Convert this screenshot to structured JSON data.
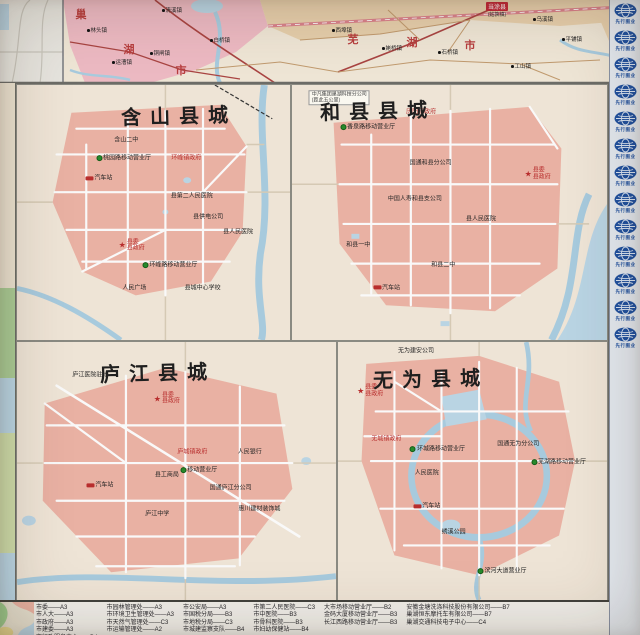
{
  "colors": {
    "urban_pink": "#f0b2a2",
    "region_pink": "#f2bac4",
    "land_cream": "#f2e7d7",
    "water_blue": "#a6cde2",
    "road_red": "#b0413e",
    "label_red": "#c22828",
    "mobile_green": "#1f8c24",
    "badge_blue": "#1950a8"
  },
  "top_map": {
    "region_chars": [
      {
        "ch": "巢",
        "x": 81,
        "y": 14
      },
      {
        "ch": "湖",
        "x": 129,
        "y": 49
      },
      {
        "ch": "市",
        "x": 181,
        "y": 70
      },
      {
        "ch": "芜",
        "x": 353,
        "y": 39
      },
      {
        "ch": "湖",
        "x": 412,
        "y": 42
      },
      {
        "ch": "市",
        "x": 470,
        "y": 45
      }
    ],
    "towns": [
      {
        "t": "清溪镇",
        "x": 172,
        "y": 10
      },
      {
        "t": "林头镇",
        "x": 97,
        "y": 30
      },
      {
        "t": "运漕镇",
        "x": 122,
        "y": 62
      },
      {
        "t": "铜闸镇",
        "x": 160,
        "y": 53
      },
      {
        "t": "白桥镇",
        "x": 220,
        "y": 40
      },
      {
        "t": "西埠镇",
        "x": 342,
        "y": 30
      },
      {
        "t": "姥桥镇",
        "x": 392,
        "y": 48
      },
      {
        "t": "石桥镇",
        "x": 448,
        "y": 52
      },
      {
        "t": "乌溪镇",
        "x": 543,
        "y": 19
      },
      {
        "t": "平铺镇",
        "x": 572,
        "y": 39
      },
      {
        "t": "工山镇",
        "x": 521,
        "y": 66
      }
    ],
    "boxed_county": {
      "line1": "当涂县",
      "line2": "(姑孰镇)",
      "x": 497,
      "y": 2
    }
  },
  "panels": [
    {
      "title": "含山县城",
      "title_pos": {
        "x": 38,
        "y": 6
      },
      "labels": [
        {
          "t": "含山二中",
          "x": 40,
          "y": 22,
          "type": "black"
        },
        {
          "t": "桃园路移动营业厅",
          "x": 39,
          "y": 29,
          "type": "green"
        },
        {
          "t": "汽车站",
          "x": 30,
          "y": 37,
          "type": "station"
        },
        {
          "t": "环峰镇政府",
          "x": 62,
          "y": 29,
          "type": "govred"
        },
        {
          "t": "县第二人民医院",
          "x": 64,
          "y": 44,
          "type": "black"
        },
        {
          "t": "县供电公司",
          "x": 70,
          "y": 52,
          "type": "black"
        },
        {
          "t": "县委/县政府",
          "x": 42,
          "y": 63,
          "type": "star"
        },
        {
          "t": "环峰路移动营业厅",
          "x": 56,
          "y": 71,
          "type": "green"
        },
        {
          "t": "县人民医院",
          "x": 81,
          "y": 58,
          "type": "black"
        },
        {
          "t": "人民广场",
          "x": 43,
          "y": 80,
          "type": "black"
        },
        {
          "t": "县城中心学校",
          "x": 68,
          "y": 80,
          "type": "black"
        }
      ]
    },
    {
      "title": "和县县城",
      "title_pos": {
        "x": 9,
        "y": 4
      },
      "labels": [
        {
          "t": "中凡集团巢湖科技分公司/(距此五公里)",
          "x": 15,
          "y": 5,
          "type": "note"
        },
        {
          "t": "历阳镇政府",
          "x": 41,
          "y": 11,
          "type": "govred"
        },
        {
          "t": "香泉路移动营业厅",
          "x": 24,
          "y": 17,
          "type": "green"
        },
        {
          "t": "国通和县分公司",
          "x": 44,
          "y": 31,
          "type": "black"
        },
        {
          "t": "县委/县政府",
          "x": 78,
          "y": 35,
          "type": "star"
        },
        {
          "t": "中国人寿和县支公司",
          "x": 39,
          "y": 45,
          "type": "black"
        },
        {
          "t": "县人民医院",
          "x": 60,
          "y": 53,
          "type": "black"
        },
        {
          "t": "和县一中",
          "x": 21,
          "y": 63,
          "type": "black"
        },
        {
          "t": "和县二中",
          "x": 48,
          "y": 71,
          "type": "black"
        },
        {
          "t": "汽车站",
          "x": 30,
          "y": 80,
          "type": "station"
        }
      ]
    },
    {
      "title": "庐江县城",
      "title_pos": {
        "x": 26,
        "y": 6
      },
      "labels": [
        {
          "t": "庐江医院驻地",
          "x": 23,
          "y": 13,
          "type": "black"
        },
        {
          "t": "县委/县政府",
          "x": 47,
          "y": 22,
          "type": "star"
        },
        {
          "t": "庐城镇政府",
          "x": 55,
          "y": 43,
          "type": "govred"
        },
        {
          "t": "人民银行",
          "x": 73,
          "y": 43,
          "type": "black"
        },
        {
          "t": "移动营业厅",
          "x": 57,
          "y": 50,
          "type": "green"
        },
        {
          "t": "县工商局",
          "x": 47,
          "y": 52,
          "type": "black"
        },
        {
          "t": "汽车站",
          "x": 26,
          "y": 56,
          "type": "station"
        },
        {
          "t": "国通庐江分公司",
          "x": 67,
          "y": 57,
          "type": "black"
        },
        {
          "t": "惠川建材装饰城",
          "x": 76,
          "y": 65,
          "type": "black"
        },
        {
          "t": "庐江中学",
          "x": 44,
          "y": 67,
          "type": "black"
        }
      ]
    },
    {
      "title": "无为县城",
      "title_pos": {
        "x": 13,
        "y": 8
      },
      "labels": [
        {
          "t": "无为建安公司",
          "x": 29,
          "y": 4,
          "type": "black"
        },
        {
          "t": "县委/县政府",
          "x": 12,
          "y": 19,
          "type": "star"
        },
        {
          "t": "无城镇政府",
          "x": 18,
          "y": 38,
          "type": "govred"
        },
        {
          "t": "环城路移动营业厅",
          "x": 37,
          "y": 42,
          "type": "green"
        },
        {
          "t": "人民医院",
          "x": 33,
          "y": 51,
          "type": "black"
        },
        {
          "t": "国通无为分公司",
          "x": 67,
          "y": 40,
          "type": "black"
        },
        {
          "t": "芜湖路移动营业厅",
          "x": 82,
          "y": 47,
          "type": "green"
        },
        {
          "t": "汽车站",
          "x": 33,
          "y": 64,
          "type": "station"
        },
        {
          "t": "绣溪公园",
          "x": 43,
          "y": 74,
          "type": "black"
        },
        {
          "t": "滨河大道营业厅",
          "x": 61,
          "y": 89,
          "type": "green"
        }
      ]
    }
  ],
  "right_strip": {
    "badge_label": "先行图业",
    "badge_count": 13
  },
  "legend": {
    "columns": [
      [
        "市委——A3",
        "市人大——A3",
        "市政府——A3",
        "市建委——A3",
        "市行政服务中心——D4"
      ],
      [
        "市园林管理处——A3",
        "市环境卫生管理处——A3",
        "市天然气管理处——C3",
        "市运输管理处——A2"
      ],
      [
        "市公安局——A3",
        "市国税分局——B3",
        "市地税分局——C3",
        "市城建监察支队——B4"
      ],
      [
        "市第二人民医院——C3",
        "市中医院——B3",
        "市骨科医院——B3",
        "市妇幼保健站——B4"
      ],
      [
        "大市场移动营业厅——B2",
        "金码大厦移动营业厅——B3",
        "长江西路移动营业厅——B3"
      ],
      [
        "安徽金塘洗涤科技股份有限公司——B7",
        "巢湖恒东摩托车有限公司——B7",
        "巢湖交通科技电子中心——C4"
      ]
    ]
  }
}
